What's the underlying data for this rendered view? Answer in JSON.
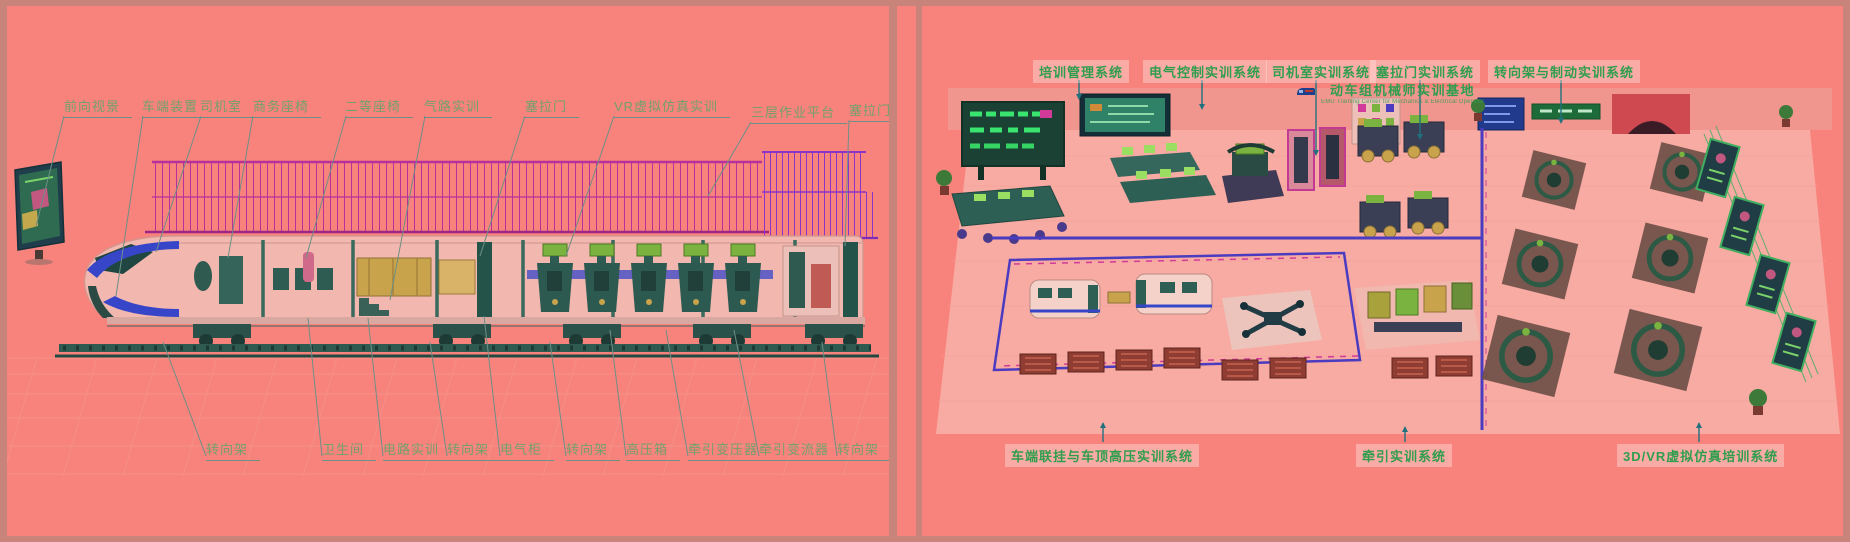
{
  "colors": {
    "background": "#f8837d",
    "frame": "#c8837b",
    "left_label_text": "#73a06c",
    "left_label_underline": "#6d8f86",
    "right_label_text": "#2f9e4e",
    "railing_magenta": "#b8309a",
    "railing_purple": "#8a35c8",
    "train_blue_stripe": "#3746c9",
    "machinery_teal": "#2e5a50",
    "vr_green": "#7ab33f",
    "callout_line": "#6d8f86",
    "arrow_teal": "#20707e",
    "led_green": "#39e56e"
  },
  "left_panel": {
    "top_labels": [
      "前向视景",
      "车端装置",
      "司机室",
      "商务座椅",
      "二等座椅",
      "气路实训",
      "塞拉门",
      "VR虚拟仿真实训",
      "三层作业平台",
      "塞拉门"
    ],
    "bottom_labels": [
      "转向架",
      "卫生间",
      "电路实训",
      "转向架",
      "电气柜",
      "转向架",
      "高压箱",
      "牵引变压器",
      "牵引变流器",
      "转向架"
    ]
  },
  "right_panel": {
    "top_labels": [
      "培训管理系统",
      "电气控制实训系统",
      "司机室实训系统",
      "塞拉门实训系统",
      "转向架与制动实训系统"
    ],
    "bottom_labels": [
      "车端联挂与车顶高压实训系统",
      "牵引实训系统",
      "3D/VR虚拟仿真培训系统"
    ],
    "sign": {
      "title": "动车组机械师实训基地",
      "subtitle": "EMU Training Center for Mechanics & Electrical Operator"
    }
  }
}
